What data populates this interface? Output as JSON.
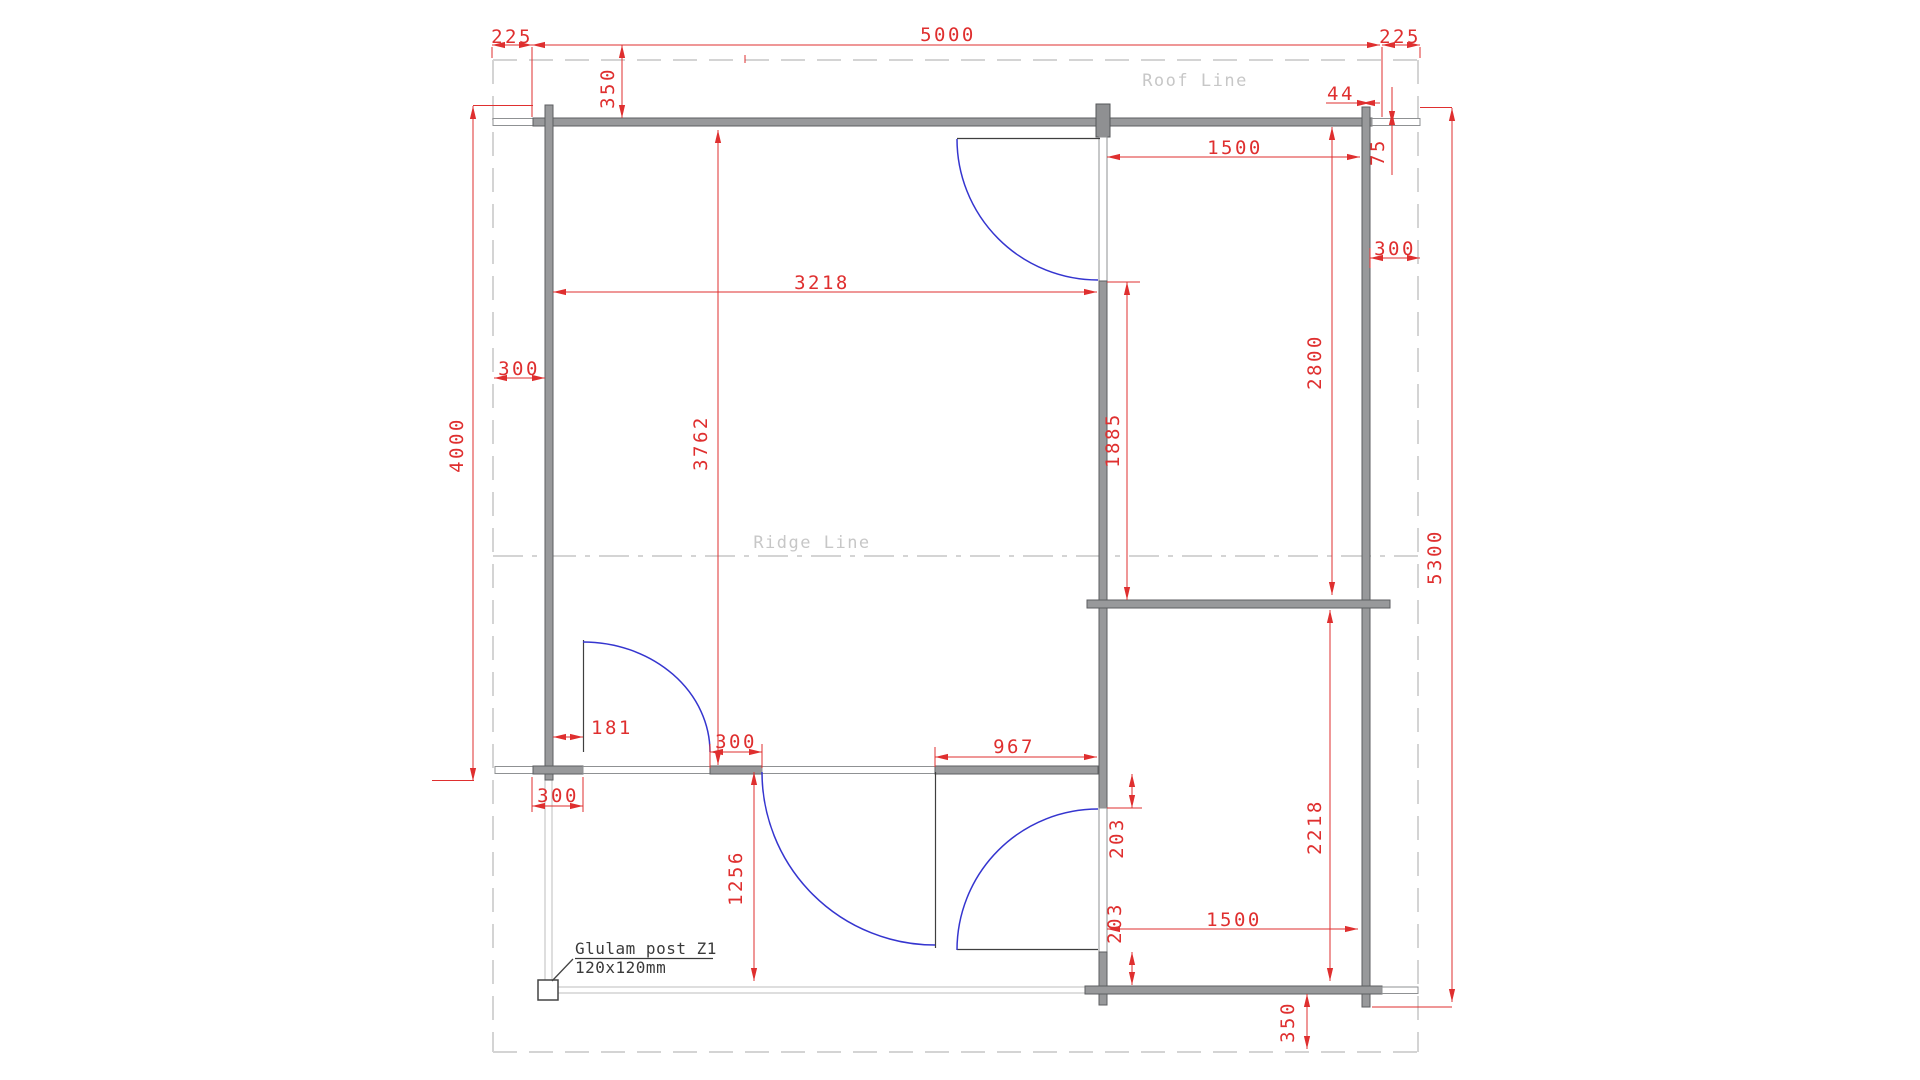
{
  "title": "Floor plan drawing",
  "labels": {
    "roof_line": "Roof Line",
    "ridge_line": "Ridge Line",
    "glulam_line1": "Glulam post Z1",
    "glulam_line2": "120x120mm"
  },
  "dims": {
    "d225l": "225",
    "d5000": "5000",
    "d225r": "225",
    "d350t": "350",
    "d44": "44",
    "d75": "75",
    "d300r": "300",
    "d1500t": "1500",
    "d3218": "3218",
    "d300l": "300",
    "d4000": "4000",
    "d3762": "3762",
    "d1885": "1885",
    "d2800": "2800",
    "d5300": "5300",
    "d181": "181",
    "d300bl": "300",
    "d300stub": "300",
    "d967": "967",
    "d1256": "1256",
    "d203u": "203",
    "d203l": "203",
    "d1500b": "1500",
    "d2218": "2218",
    "d350b": "350"
  },
  "colors": {
    "dimension_red": "#df2f2f",
    "wall_gray": "#98999b",
    "door_blue": "#3535cf",
    "roof_guide_gray": "#d4d4d4",
    "label_gray": "#c7c7c7",
    "annotation_dark": "#3a3a3a"
  }
}
